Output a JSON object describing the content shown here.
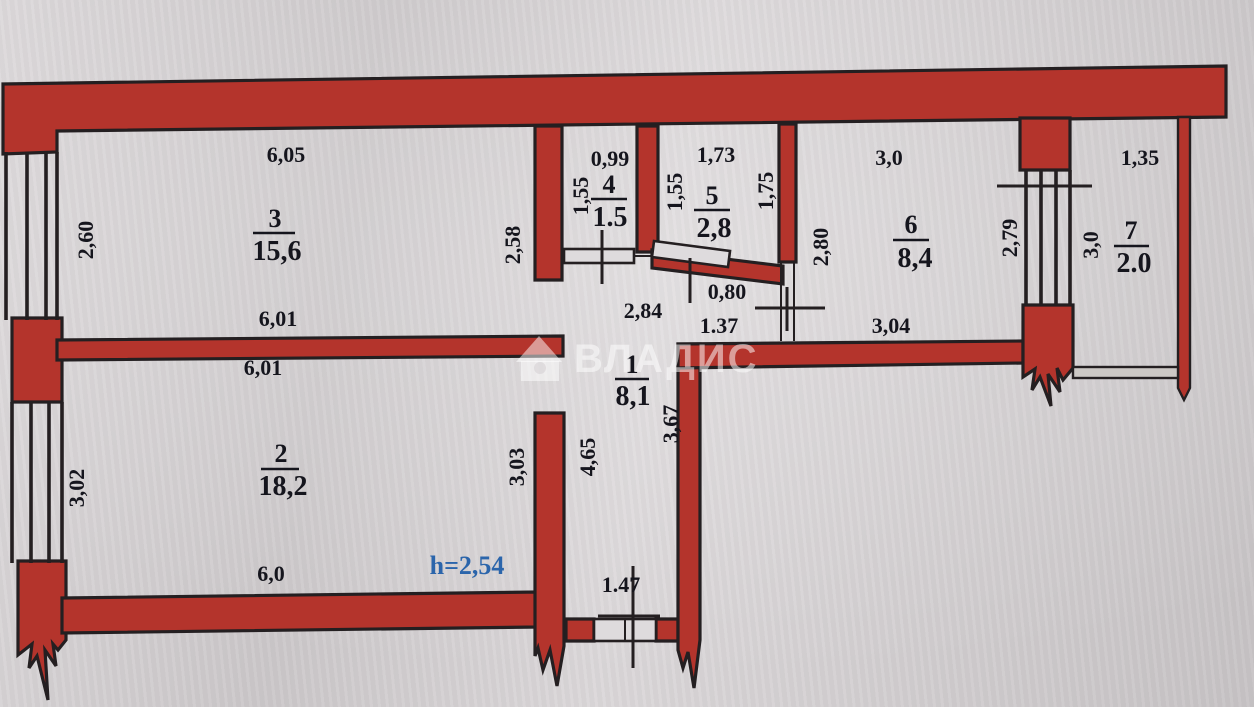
{
  "plan": {
    "watermark": "ВЛАДИС",
    "ceiling_height": "h=2,54",
    "colors": {
      "wall_red": "#b4342c",
      "outline": "#241f21",
      "paper": "#d7d3d5",
      "text": "#15151d",
      "height_blue": "#2b65ab"
    },
    "rooms": [
      {
        "num": "1",
        "area": "8,1"
      },
      {
        "num": "2",
        "area": "18,2"
      },
      {
        "num": "3",
        "area": "15,6"
      },
      {
        "num": "4",
        "area": "1.5"
      },
      {
        "num": "5",
        "area": "2,8"
      },
      {
        "num": "6",
        "area": "8,4"
      },
      {
        "num": "7",
        "area": "2.0"
      }
    ],
    "dims": {
      "room3_top": "6,05",
      "room3_left": "2,60",
      "room3_right": "2,58",
      "divider_above": "6,01",
      "divider_below": "6,01",
      "room2_left": "3,02",
      "room2_right": "3,03",
      "room2_bottom": "6,0",
      "room4_top": "0,99",
      "room4_left": "1,55",
      "room5_top": "1,73",
      "room5_left": "1,55",
      "room5_right": "1,75",
      "room6_top": "3,0",
      "room6_left": "2,80",
      "room6_right": "2,79",
      "room6_bottom": "3,04",
      "room7_top": "1,35",
      "room7_left": "3,0",
      "hall_top": "2,84",
      "hall_door": "0,80",
      "hall_right": "1.37",
      "hall_side": "3,67",
      "hall_left": "4,65",
      "entry_door": "1.47"
    }
  }
}
